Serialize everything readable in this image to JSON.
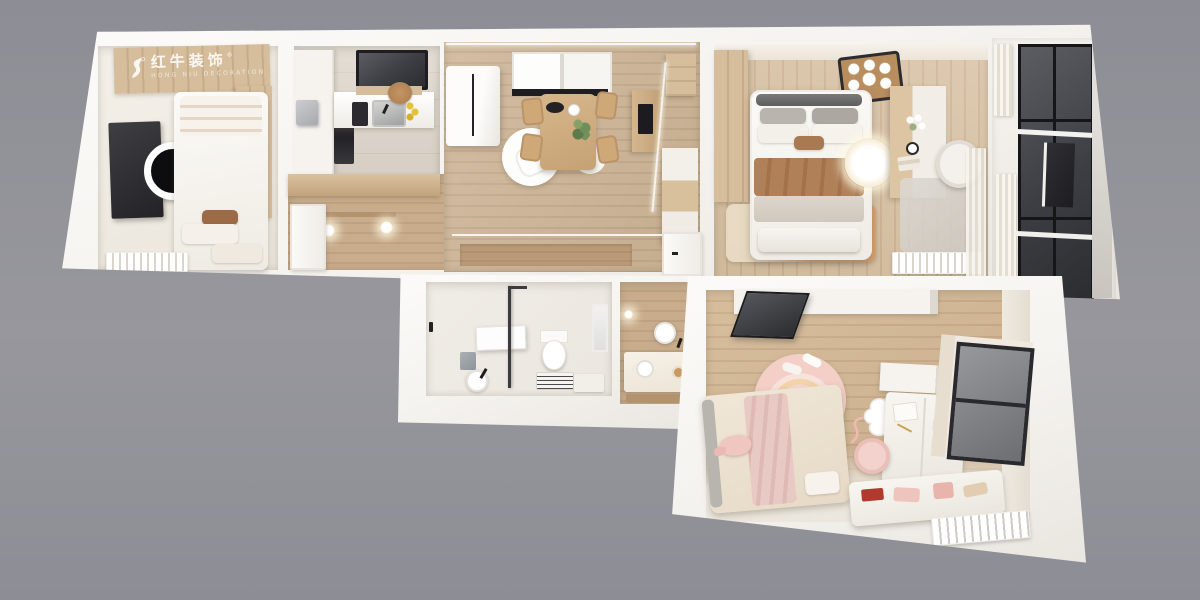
{
  "watermark": {
    "brand": "红牛装饰",
    "registered_mark": "®",
    "caption": "HONG NIU DECORATION"
  },
  "palette": {
    "bg": "#97979d",
    "bg2": "#8d8d95",
    "wall": "#f5f3ef",
    "cream": "#f1ece3",
    "wood_floor": "#ccb394",
    "wood_floor_d": "#c2a787",
    "wood_master": "#d8c1a2",
    "wood_kids": "#d2b691",
    "wood_hall": "#c8ac8b",
    "wood_panel": "#d6bd9c",
    "wood_dark": "#b3926e",
    "tile_kitchen": "#dad2c7",
    "tile_bath": "#ebe7e0",
    "glass_dark": "#46484d",
    "frame_black": "#1e1e22",
    "pure_white": "#fbfaf8",
    "pink_plush": "#f0c6c1",
    "pink_rug": "#f6d9d3",
    "rug_tan": "#db9f6b",
    "blanket_brown": "#b08159",
    "pillow_brown": "#9c6a47",
    "appliance_gray": "#b9bcbe",
    "lemon": "#e3c235",
    "plant_green": "#6f8f5a",
    "marble": "#d8d4ce"
  },
  "rooms": [
    "bedroom",
    "kitchen",
    "entry-hallway",
    "living-dining-room",
    "master-bedroom",
    "balcony",
    "bathroom",
    "wash-nook",
    "kids-bedroom"
  ]
}
